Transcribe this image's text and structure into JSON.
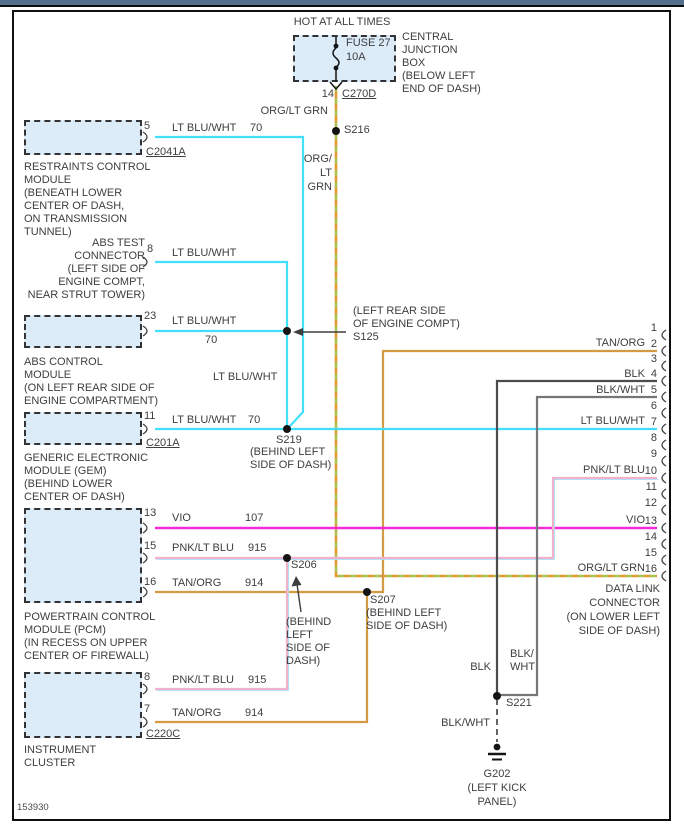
{
  "footer_id": "153930",
  "colors": {
    "lt_blu_wht": "#41DFFB",
    "vio": "#F32BD8",
    "pnk": "#F6AFC9",
    "lt_blu": "#A8DCF5",
    "tan_org": "#D49B43",
    "org": "#E09B2E",
    "lt_grn": "#8BD867",
    "blk": "#4C4C4E",
    "blk_wht": "#747678",
    "box_fill": "#DCEBF8",
    "top_strip": "#53708C"
  },
  "power": {
    "hot": "HOT AT ALL TIMES",
    "fuse_name": "FUSE 27",
    "fuse_rating": "10A",
    "cjb": [
      "CENTRAL",
      "JUNCTION",
      "BOX",
      "(BELOW LEFT",
      "END OF DASH)"
    ],
    "pin": "14",
    "connector": "C270D",
    "wire": "ORG/LT GRN",
    "wire_stack": [
      "ORG/",
      "LT",
      "GRN"
    ],
    "splice": "S216"
  },
  "modules": {
    "restraints": {
      "pin": "5",
      "wire": "LT BLU/WHT",
      "circuit": "70",
      "connector": "C2041A",
      "desc": [
        "RESTRAINTS CONTROL",
        "MODULE",
        "(BENEATH LOWER",
        "CENTER OF DASH,",
        "ON TRANSMISSION",
        "TUNNEL)"
      ]
    },
    "abs_test": {
      "pin": "8",
      "wire": "LT BLU/WHT",
      "desc": [
        "ABS TEST",
        "CONNECTOR",
        "(LEFT SIDE OF",
        "ENGINE COMPT,",
        "NEAR STRUT TOWER)"
      ]
    },
    "abs_ctrl": {
      "pin": "23",
      "wire": "LT BLU/WHT",
      "circuit": "70",
      "desc": [
        "ABS CONTROL",
        "MODULE",
        "(ON LEFT REAR SIDE OF",
        "ENGINE COMPARTMENT)"
      ]
    },
    "gem": {
      "pin": "11",
      "wire": "LT BLU/WHT",
      "circuit": "70",
      "connector": "C201A",
      "desc": [
        "GENERIC ELECTRONIC",
        "MODULE (GEM)",
        "(BEHIND LOWER",
        "CENTER OF DASH)"
      ]
    },
    "pcm": {
      "pins": [
        {
          "pin": "13",
          "wire": "VIO",
          "circuit": "107"
        },
        {
          "pin": "15",
          "wire": "PNK/LT BLU",
          "circuit": "915"
        },
        {
          "pin": "16",
          "wire": "TAN/ORG",
          "circuit": "914"
        }
      ],
      "desc": [
        "POWERTRAIN CONTROL",
        "MODULE (PCM)",
        "(IN RECESS ON UPPER",
        "CENTER OF FIREWALL)"
      ]
    },
    "cluster": {
      "pins": [
        {
          "pin": "8",
          "wire": "PNK/LT BLU",
          "circuit": "915"
        },
        {
          "pin": "7",
          "wire": "TAN/ORG",
          "circuit": "914"
        }
      ],
      "connector": "C220C",
      "desc": [
        "INSTRUMENT",
        "CLUSTER"
      ]
    }
  },
  "splices": {
    "s125": {
      "label": "S125",
      "loc": [
        "(LEFT REAR SIDE",
        "OF ENGINE COMPT)"
      ]
    },
    "s219": {
      "label": "S219",
      "loc": [
        "(BEHIND LEFT",
        "SIDE OF DASH)"
      ]
    },
    "s206": {
      "label": "S206",
      "loc": [
        "(BEHIND",
        "LEFT",
        "SIDE OF",
        "DASH)"
      ]
    },
    "s207": {
      "label": "S207",
      "loc": [
        "(BEHIND LEFT",
        "SIDE OF DASH)"
      ]
    },
    "s221": {
      "label": "S221"
    },
    "mid_wire_label": "LT BLU/WHT"
  },
  "ground": {
    "label": "G202",
    "loc": [
      "(LEFT KICK",
      "PANEL)"
    ],
    "blk_label": "BLK",
    "blk_wht_stack": [
      "BLK/",
      "WHT"
    ],
    "blk_wht_label": "BLK/WHT"
  },
  "dlc": {
    "desc": [
      "DATA LINK",
      "CONNECTOR",
      "(ON LOWER LEFT",
      "SIDE OF DASH)"
    ],
    "pins": [
      {
        "n": "1",
        "wire": ""
      },
      {
        "n": "2",
        "wire": "TAN/ORG"
      },
      {
        "n": "3",
        "wire": ""
      },
      {
        "n": "4",
        "wire": "BLK"
      },
      {
        "n": "5",
        "wire": "BLK/WHT"
      },
      {
        "n": "6",
        "wire": ""
      },
      {
        "n": "7",
        "wire": "LT BLU/WHT"
      },
      {
        "n": "8",
        "wire": ""
      },
      {
        "n": "9",
        "wire": ""
      },
      {
        "n": "10",
        "wire": "PNK/LT BLU"
      },
      {
        "n": "11",
        "wire": ""
      },
      {
        "n": "12",
        "wire": ""
      },
      {
        "n": "13",
        "wire": "VIO"
      },
      {
        "n": "14",
        "wire": ""
      },
      {
        "n": "15",
        "wire": ""
      },
      {
        "n": "16",
        "wire": "ORG/LT GRN"
      }
    ]
  }
}
